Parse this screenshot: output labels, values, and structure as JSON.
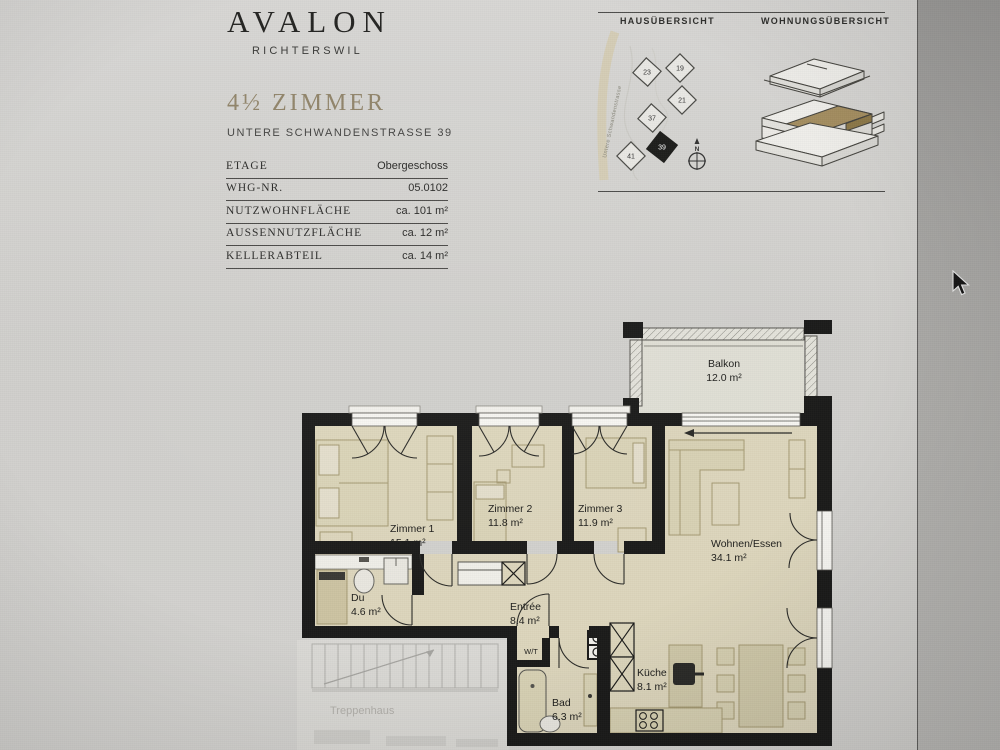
{
  "brand": {
    "name": "AVALON",
    "subtitle": "RICHTERSWIL"
  },
  "unit": {
    "title": "4½ ZIMMER",
    "address": "UNTERE SCHWANDENSTRASSE 39"
  },
  "details": {
    "rows": [
      {
        "label": "ETAGE",
        "value": "Obergeschoss"
      },
      {
        "label": "WHG-NR.",
        "value": "05.0102"
      },
      {
        "label": "NUTZWOHNFLÄCHE",
        "value": "ca. 101 m²"
      },
      {
        "label": "AUSSENNUTZFLÄCHE",
        "value": "ca. 12 m²"
      },
      {
        "label": "KELLERABTEIL",
        "value": "ca. 14 m²"
      }
    ]
  },
  "overview": {
    "haus_title": "HAUSÜBERSICHT",
    "wohnung_title": "WOHNUNGSÜBERSICHT",
    "street": "Untere Schwandenstrasse",
    "compass": "N",
    "buildings": [
      "23",
      "19",
      "21",
      "37",
      "41",
      "39"
    ],
    "highlighted_building": "39"
  },
  "floorplan": {
    "rooms": [
      {
        "name": "Balkon",
        "area": "12.0 m²"
      },
      {
        "name": "Zimmer 1",
        "area": "15.1 m²"
      },
      {
        "name": "Zimmer 2",
        "area": "11.8 m²"
      },
      {
        "name": "Zimmer 3",
        "area": "11.9 m²"
      },
      {
        "name": "Wohnen/Essen",
        "area": "34.1 m²"
      },
      {
        "name": "Du",
        "area": "4.6 m²"
      },
      {
        "name": "Entrée",
        "area": "8.4 m²"
      },
      {
        "name": "Bad",
        "area": "6.3 m²"
      },
      {
        "name": "Küche",
        "area": "8.1 m²"
      },
      {
        "name": "W/T",
        "area": ""
      }
    ],
    "stairwell_label": "Treppenhaus"
  },
  "colors": {
    "accent_gold": "#91856a",
    "wall": "#1a1a19",
    "room_floor": "#ddd6bc",
    "furniture": "#a59a73",
    "highlight_unit": "#a48e60",
    "page": "#d3d2cf"
  }
}
